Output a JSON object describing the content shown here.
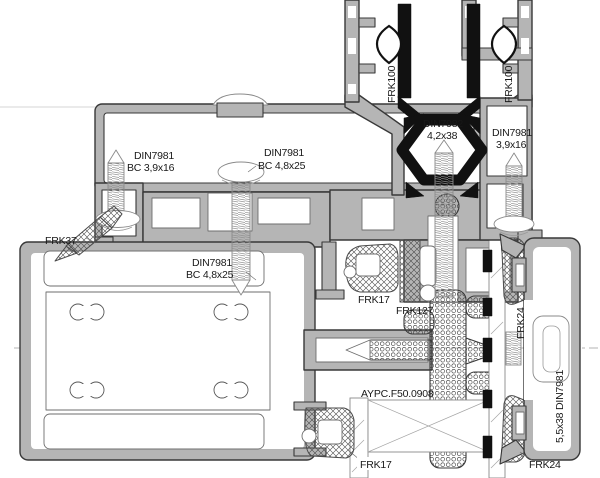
{
  "drawing": {
    "kind": "aluminium profile section node",
    "colors": {
      "background": "#ffffff",
      "aluminum": "#b5b5b5",
      "outline": "#383838",
      "gasket_black": "#111111",
      "hatch": "#4a4a4a",
      "phantom": "#8a8a8a",
      "centerline": "#9b9b9b"
    },
    "labels": {
      "frk100_left": "FRK100",
      "frk100_right": "FRK100",
      "din7982_center": {
        "l1": "DIN7982",
        "l2": "4,2x38"
      },
      "din7981_right_top": {
        "l1": "DIN7981",
        "l2": "3,9x16"
      },
      "din7981_head_left": {
        "l1": "DIN7981",
        "l2": "BC 3,9x16"
      },
      "din7981_head_right": {
        "l1": "DIN7981",
        "l2": "BC 4,8x25"
      },
      "frk37": "FRK37",
      "din7981_frame": {
        "l1": "DIN7981",
        "l2": "BC 4,8x25"
      },
      "frk17_mid": "FRK17",
      "frk127": "FRK127",
      "frk24_side": "FRK24",
      "aypc_profile": "AYPC.F50.0908",
      "din7981_bead": "5,5x38 DIN7981",
      "frk17_bottom": "FRK17",
      "frk24_bottom": "FRK24"
    }
  }
}
